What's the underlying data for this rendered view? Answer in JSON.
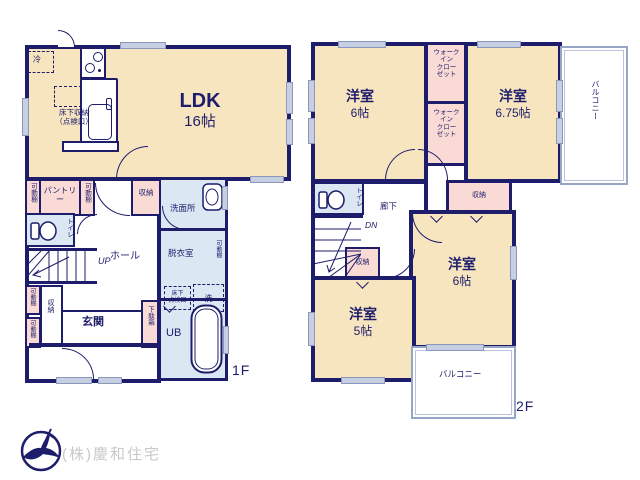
{
  "plan1f": {
    "floor_label": "1F",
    "ldk_name": "LDK",
    "ldk_size": "16帖",
    "fridge": "冷",
    "underfloor_storage": "床下収納\n（点検口）",
    "movable_shelf": "可動棚",
    "pantry": "パントリー",
    "hall_storage": "収納",
    "washroom": "洗面所",
    "dressing_room": "脱衣室",
    "underfloor_hatch": "床下\n点検口",
    "washer": "洗",
    "toilet": "トイレ",
    "up": "UP",
    "hall": "ホール",
    "stairs_storage": "収納",
    "entrance": "玄関",
    "shoe_box": "下駄箱",
    "unit_bath": "UB"
  },
  "plan2f": {
    "floor_label": "2F",
    "bedroom_a_name": "洋室",
    "bedroom_a_size": "6帖",
    "wic": "ウォーク\nイン\nクロー\nゼット",
    "bedroom_b_name": "洋室",
    "bedroom_b_size": "6.75帖",
    "balcony_right": "バルコニー",
    "toilet": "トイレ",
    "corridor": "廊下",
    "down": "DN",
    "corridor_storage": "収納",
    "stairs_storage": "収納",
    "bedroom_c_name": "洋室",
    "bedroom_c_size": "6帖",
    "bedroom_d_name": "洋室",
    "bedroom_d_size": "5帖",
    "balcony_bottom": "バルコニー"
  },
  "footer": {
    "company": "(株)慶和住宅"
  },
  "colors": {
    "wall": "#1d1d6b",
    "room_fill": "#f7e5bf",
    "storage_fill": "#f9dad4",
    "wet_area_fill": "#dbe8f4",
    "window_mark": "#c7cfe2",
    "balcony_line": "#98a6c6",
    "company_text": "#c9c9c9"
  }
}
